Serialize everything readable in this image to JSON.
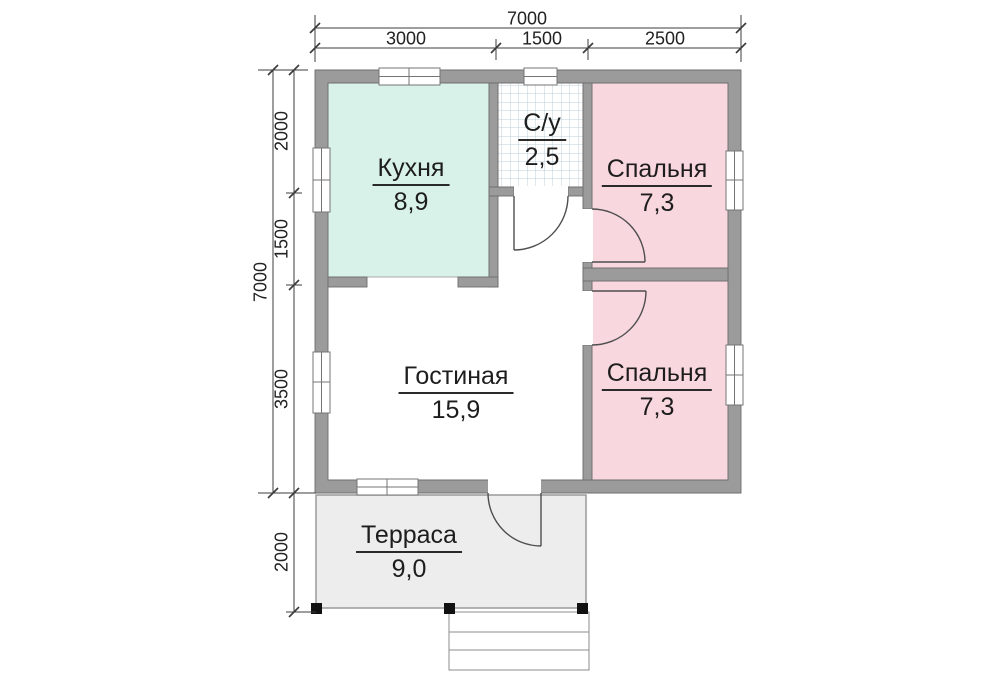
{
  "meta": {
    "type": "floor-plan",
    "language": "ru"
  },
  "rooms": {
    "kitchen": {
      "name": "Кухня",
      "area": "8,9"
    },
    "bathroom": {
      "name": "С/у",
      "area": "2,5"
    },
    "bedroom1": {
      "name": "Спальня",
      "area": "7,3"
    },
    "bedroom2": {
      "name": "Спальня",
      "area": "7,3"
    },
    "living": {
      "name": "Гостиная",
      "area": "15,9"
    },
    "terrace": {
      "name": "Терраса",
      "area": "9,0"
    }
  },
  "dimensions": {
    "top": {
      "total": "7000",
      "segments": [
        "3000",
        "1500",
        "2500"
      ]
    },
    "left": {
      "total": "7000",
      "segments": [
        "2000",
        "1500",
        "3500"
      ]
    },
    "terrace": {
      "depth": "2000"
    }
  },
  "colors": {
    "wall": "#9b9b9b",
    "wall_outline": "#6d6d6d",
    "kitchen_fill": "#d8f1e9",
    "bedroom_fill": "#f9d7de",
    "terrace_fill": "#ededee",
    "tile_line": "#bcd2da",
    "dimension_line": "#3c3c3c",
    "text": "#1d1d1d"
  }
}
